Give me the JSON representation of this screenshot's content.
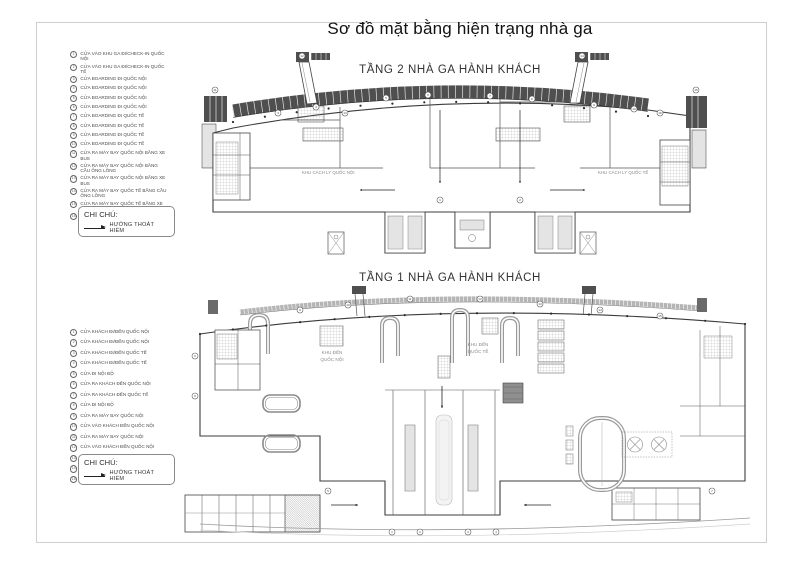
{
  "page": {
    "title": "Sơ đồ mặt bằng hiện trạng nhà ga"
  },
  "note": {
    "label": "CHI CHÚ:",
    "arrow_text": "HƯỚNG THOÁT HIỂM"
  },
  "floor2": {
    "title": "TẦNG 2 NHÀ GA HÀNH KHÁCH",
    "area_labels": {
      "left": "KHU CÁCH LY QUỐC NỘI",
      "right": "KHU CÁCH LY QUỐC TẾ"
    },
    "legend": {
      "items": [
        {
          "n": "1",
          "text": "CỬA VÀO KHU GA ĐI/CHECK-IN QUỐC NỘI"
        },
        {
          "n": "2",
          "text": "CỬA VÀO KHU GA ĐI/CHECK-IN QUỐC TẾ"
        },
        {
          "n": "3",
          "text": "CỬA BOARDING ĐI QUỐC NỘI"
        },
        {
          "n": "4",
          "text": "CỬA BOARDING ĐI QUỐC NỘI"
        },
        {
          "n": "5",
          "text": "CỬA BOARDING ĐI QUỐC NỘI"
        },
        {
          "n": "6",
          "text": "CỬA BOARDING ĐI QUỐC NỘI"
        },
        {
          "n": "7",
          "text": "CỬA BOARDING ĐI QUỐC TẾ"
        },
        {
          "n": "8",
          "text": "CỬA BOARDING ĐI QUỐC TẾ"
        },
        {
          "n": "9",
          "text": "CỬA BOARDING ĐI QUỐC TẾ"
        },
        {
          "n": "10",
          "text": "CỬA BOARDING ĐI QUỐC TẾ"
        },
        {
          "n": "11",
          "text": "CỬA RA MÁY BAY QUỐC NỘI BẰNG XE BUS"
        },
        {
          "n": "12",
          "text": "CỬA RA MÁY BAY QUỐC NỘI BẰNG CẦU ỐNG LỒNG"
        },
        {
          "n": "13",
          "text": "CỬA RA MÁY BAY QUỐC NỘI BẰNG XE BUS"
        },
        {
          "n": "14",
          "text": "CỬA RA MÁY BAY QUỐC TẾ BẰNG CẦU ỐNG LỒNG"
        },
        {
          "n": "15",
          "text": "CỬA RA MÁY BAY QUỐC TẾ BẰNG XE BUS"
        },
        {
          "n": "16",
          "text": "CỬA RA MÁY BAY QUỐC TẾ BẰNG XE BUS"
        }
      ]
    },
    "markers": [
      {
        "n": "11",
        "x": 25,
        "y": 40
      },
      {
        "n": "3",
        "x": 88,
        "y": 63
      },
      {
        "n": "4",
        "x": 126,
        "y": 57
      },
      {
        "n": "12",
        "x": 112,
        "y": 6
      },
      {
        "n": "5",
        "x": 196,
        "y": 48
      },
      {
        "n": "6",
        "x": 238,
        "y": 45
      },
      {
        "n": "1",
        "x": 250,
        "y": 150
      },
      {
        "n": "2",
        "x": 330,
        "y": 150
      },
      {
        "n": "7",
        "x": 300,
        "y": 46
      },
      {
        "n": "8",
        "x": 342,
        "y": 49
      },
      {
        "n": "14",
        "x": 392,
        "y": 6
      },
      {
        "n": "9",
        "x": 404,
        "y": 55
      },
      {
        "n": "10",
        "x": 444,
        "y": 59
      },
      {
        "n": "16",
        "x": 470,
        "y": 63
      },
      {
        "n": "13",
        "x": 155,
        "y": 63
      },
      {
        "n": "15",
        "x": 506,
        "y": 40
      }
    ]
  },
  "floor1": {
    "title": "TẦNG 1 NHÀ GA HÀNH KHÁCH",
    "area_labels": {
      "left_lines": [
        "KHU ĐẾN",
        "QUỐC NỘI"
      ],
      "right_lines": [
        "KHU ĐẾN",
        "QUỐC TẾ"
      ]
    },
    "legend": {
      "items": [
        {
          "n": "1",
          "text": "CỬA KHÁCH ĐI/ĐẾN QUỐC NỘI"
        },
        {
          "n": "2",
          "text": "CỬA KHÁCH ĐI/ĐẾN QUỐC NỘI"
        },
        {
          "n": "3",
          "text": "CỬA KHÁCH ĐI/ĐẾN QUỐC TẾ"
        },
        {
          "n": "4",
          "text": "CỬA KHÁCH ĐI/ĐẾN QUỐC TẾ"
        },
        {
          "n": "5",
          "text": "CỬA ĐI NỘI BỘ"
        },
        {
          "n": "6",
          "text": "CỬA RA KHÁCH ĐẾN QUỐC NỘI"
        },
        {
          "n": "7",
          "text": "CỬA RA KHÁCH ĐẾN QUỐC TẾ"
        },
        {
          "n": "8",
          "text": "CỬA ĐI NỘI BỘ"
        },
        {
          "n": "9",
          "text": "CỬA RA MÁY BAY QUỐC NỘI"
        },
        {
          "n": "10",
          "text": "CỬA VÀO KHÁCH ĐẾN QUỐC NỘI"
        },
        {
          "n": "11",
          "text": "CỬA RA MÁY BAY QUỐC NỘI"
        },
        {
          "n": "12",
          "text": "CỬA VÀO KHÁCH ĐẾN QUỐC NỘI"
        },
        {
          "n": "13",
          "text": "CỬA RA MÁY BAY QUỐC TẾ"
        },
        {
          "n": "14",
          "text": "CỬA VÀO KHÁCH ĐẾN QUỐC TẾ"
        },
        {
          "n": "15",
          "text": "CỬA RA MÁY BAY QUỐC TẾ"
        }
      ]
    },
    "markers": [
      {
        "n": "6",
        "x": 15,
        "y": 70
      },
      {
        "n": "8",
        "x": 15,
        "y": 110
      },
      {
        "n": "9",
        "x": 120,
        "y": 24
      },
      {
        "n": "10",
        "x": 168,
        "y": 19
      },
      {
        "n": "11",
        "x": 230,
        "y": 13
      },
      {
        "n": "12",
        "x": 300,
        "y": 13
      },
      {
        "n": "13",
        "x": 360,
        "y": 18
      },
      {
        "n": "14",
        "x": 420,
        "y": 24
      },
      {
        "n": "15",
        "x": 480,
        "y": 30
      },
      {
        "n": "5",
        "x": 148,
        "y": 205
      },
      {
        "n": "7",
        "x": 532,
        "y": 205
      },
      {
        "n": "1",
        "x": 212,
        "y": 246
      },
      {
        "n": "2",
        "x": 240,
        "y": 246
      },
      {
        "n": "3",
        "x": 288,
        "y": 246
      },
      {
        "n": "4",
        "x": 316,
        "y": 246
      }
    ]
  }
}
